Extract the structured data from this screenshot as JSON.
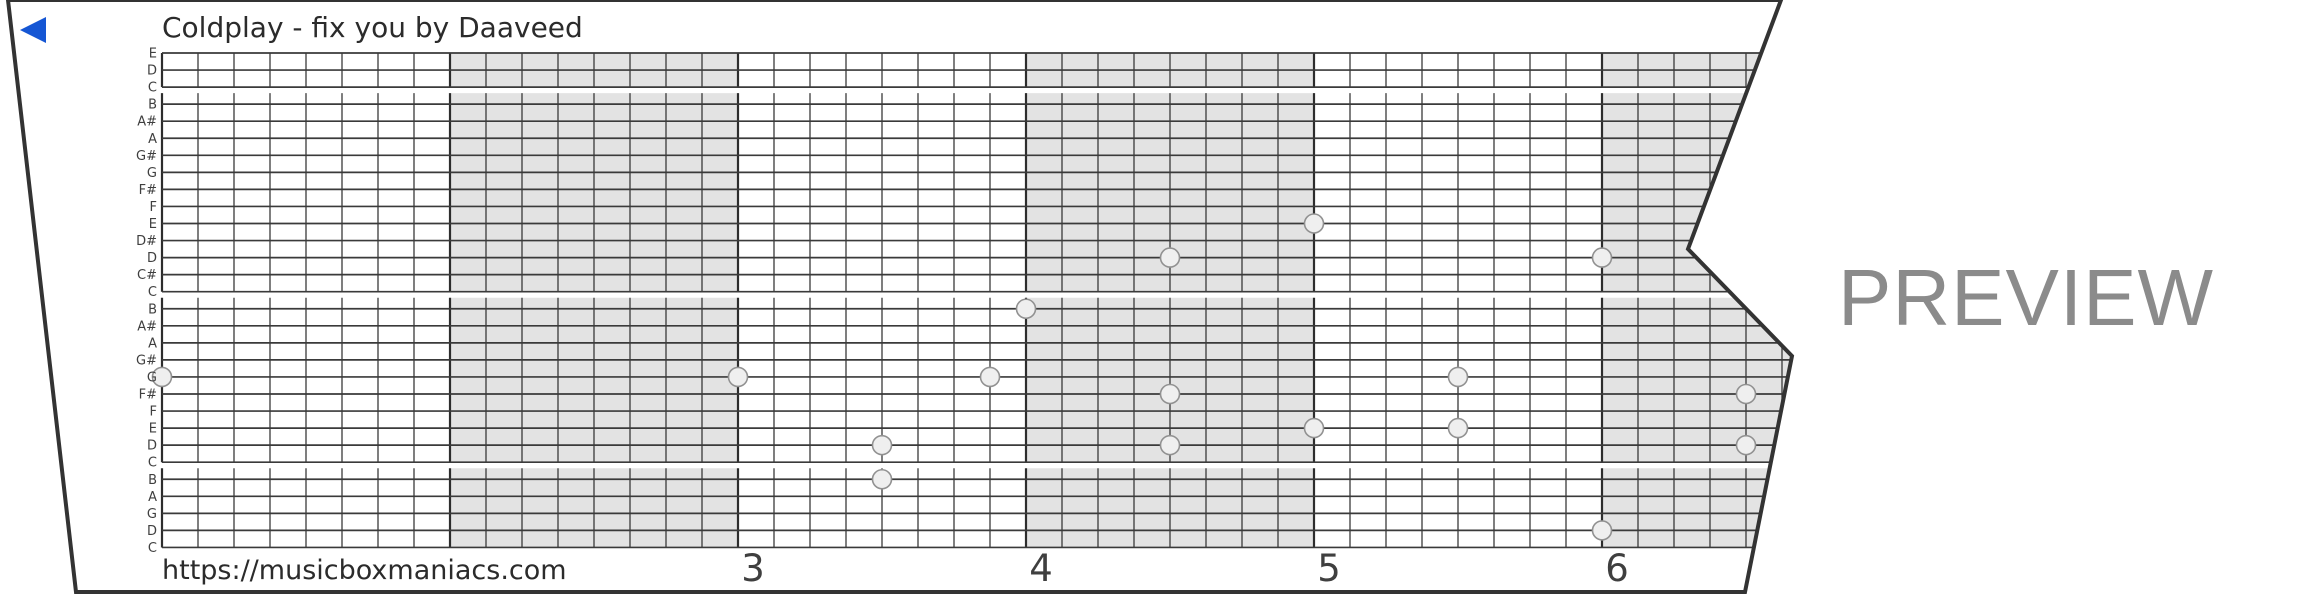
{
  "header": {
    "title": "Coldplay - fix you by Daaveed"
  },
  "footer": {
    "url": "https://musicboxmaniacs.com"
  },
  "watermark": {
    "text": "PREVIEW"
  },
  "icons": {
    "back": "back-triangle-icon"
  },
  "colors": {
    "accent_blue": "#1556d4",
    "grid_line": "#3a3a3a",
    "measure_line": "#2d2d2d",
    "shade": "#e3e3e3",
    "note_fill": "#efefef",
    "note_stroke": "#919191",
    "label_text": "#3f3f3f",
    "number_text": "#3f3f3f",
    "border": "#333333",
    "watermark_gray": "#8b8b8b"
  },
  "strip": {
    "note_labels": [
      "E",
      "D",
      "C",
      "B",
      "A#",
      "A",
      "G#",
      "G",
      "F#",
      "F",
      "E",
      "D#",
      "D",
      "C#",
      "C",
      "B",
      "A#",
      "A",
      "G#",
      "G",
      "F#",
      "F",
      "E",
      "D",
      "C",
      "B",
      "A",
      "G",
      "D",
      "C"
    ],
    "row_groups": [
      [
        0,
        2
      ],
      [
        3,
        14
      ],
      [
        15,
        24
      ],
      [
        25,
        29
      ]
    ],
    "shaded_measures": [
      2,
      4,
      6
    ],
    "measure_numbers": [
      {
        "label": "3",
        "boundary": 2
      },
      {
        "label": "4",
        "boundary": 3
      },
      {
        "label": "5",
        "boundary": 4
      },
      {
        "label": "6",
        "boundary": 5
      }
    ],
    "notes": [
      {
        "col": 0,
        "row": 19,
        "pitch": "G"
      },
      {
        "col": 16,
        "row": 19,
        "pitch": "G"
      },
      {
        "col": 20,
        "row": 23,
        "pitch": "D"
      },
      {
        "col": 20,
        "row": 25,
        "pitch": "B"
      },
      {
        "col": 23,
        "row": 19,
        "pitch": "G"
      },
      {
        "col": 24,
        "row": 15,
        "pitch": "B"
      },
      {
        "col": 28,
        "row": 12,
        "pitch": "D"
      },
      {
        "col": 28,
        "row": 20,
        "pitch": "F#"
      },
      {
        "col": 28,
        "row": 23,
        "pitch": "D"
      },
      {
        "col": 32,
        "row": 10,
        "pitch": "E"
      },
      {
        "col": 32,
        "row": 22,
        "pitch": "E"
      },
      {
        "col": 36,
        "row": 19,
        "pitch": "G"
      },
      {
        "col": 36,
        "row": 22,
        "pitch": "E"
      },
      {
        "col": 40,
        "row": 12,
        "pitch": "D"
      },
      {
        "col": 40,
        "row": 28,
        "pitch": "D"
      },
      {
        "col": 44,
        "row": 20,
        "pitch": "F#"
      },
      {
        "col": 44,
        "row": 23,
        "pitch": "D"
      }
    ],
    "geometry": {
      "x0": 162,
      "cell_w": 36,
      "cells_per_measure": 8,
      "num_cols": 48,
      "y0": 53,
      "row_h": 17.05,
      "lead_in": 11,
      "right_extent": 1830,
      "note_radius": 9.5,
      "outline": [
        [
          8,
          0
        ],
        [
          1781,
          0
        ],
        [
          1688,
          249
        ],
        [
          1792,
          356
        ],
        [
          1745,
          592
        ],
        [
          76,
          592
        ]
      ]
    }
  }
}
